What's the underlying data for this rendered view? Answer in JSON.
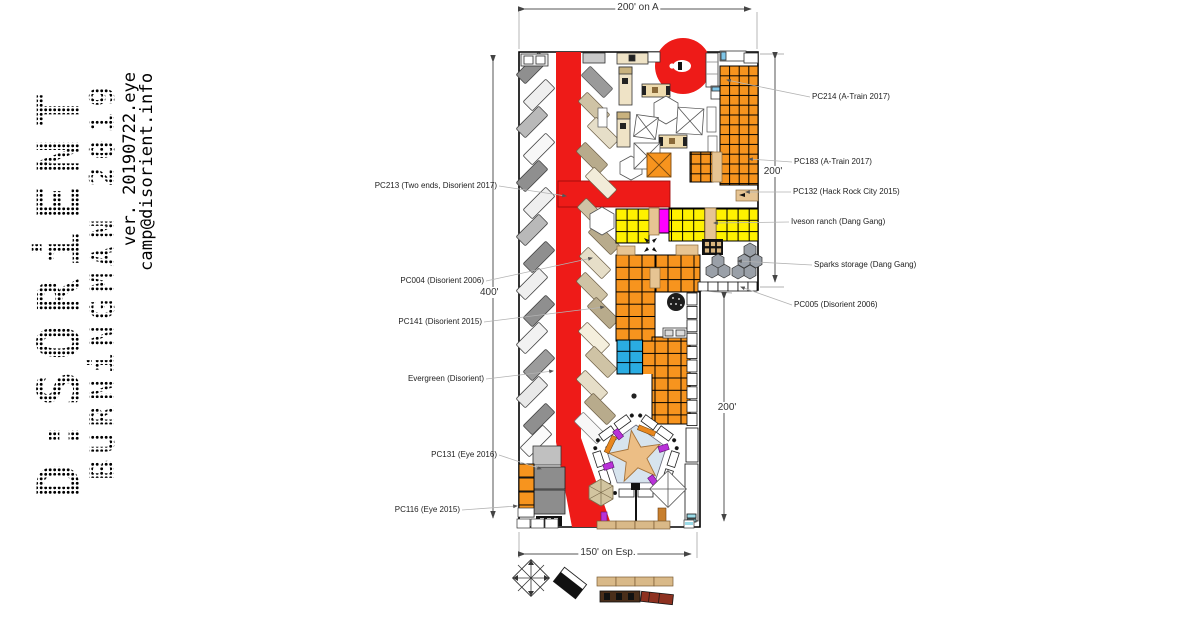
{
  "branding": {
    "title": "D:SORiENT",
    "subtitle": "BURNiNGMAN 2019",
    "version": "ver. 20190722.eye",
    "contact": "camp@disorient.info"
  },
  "dimensions": {
    "top": "200' on A",
    "left": "400'",
    "right_upper": "200'",
    "right_lower": "200'",
    "bottom": "150' on Esp."
  },
  "callouts_left": [
    {
      "label": "PC213 (Two ends, Disorient 2017)"
    },
    {
      "label": "PC004 (Disorient 2006)"
    },
    {
      "label": "PC141 (Disorient 2015)"
    },
    {
      "label": "Evergreen (Disorient)"
    },
    {
      "label": "PC131 (Eye 2016)"
    },
    {
      "label": "PC116 (Eye 2015)"
    }
  ],
  "callouts_right": [
    {
      "label": "PC214 (A-Train 2017)"
    },
    {
      "label": "PC183 (A-Train 2017)"
    },
    {
      "label": "PC132 (Hack Rock City 2015)"
    },
    {
      "label": "Iveson ranch (Dang Gang)"
    },
    {
      "label": "Sparks storage (Dang Gang)"
    },
    {
      "label": "PC005 (Disorient 2006)"
    }
  ],
  "colors": {
    "road_red": "#ee1b18",
    "camp_orange": "#f7941e",
    "camp_yellow": "#fff100",
    "camp_blue": "#2aace2",
    "magenta": "#ff00ff",
    "tan": "#e6c493"
  }
}
